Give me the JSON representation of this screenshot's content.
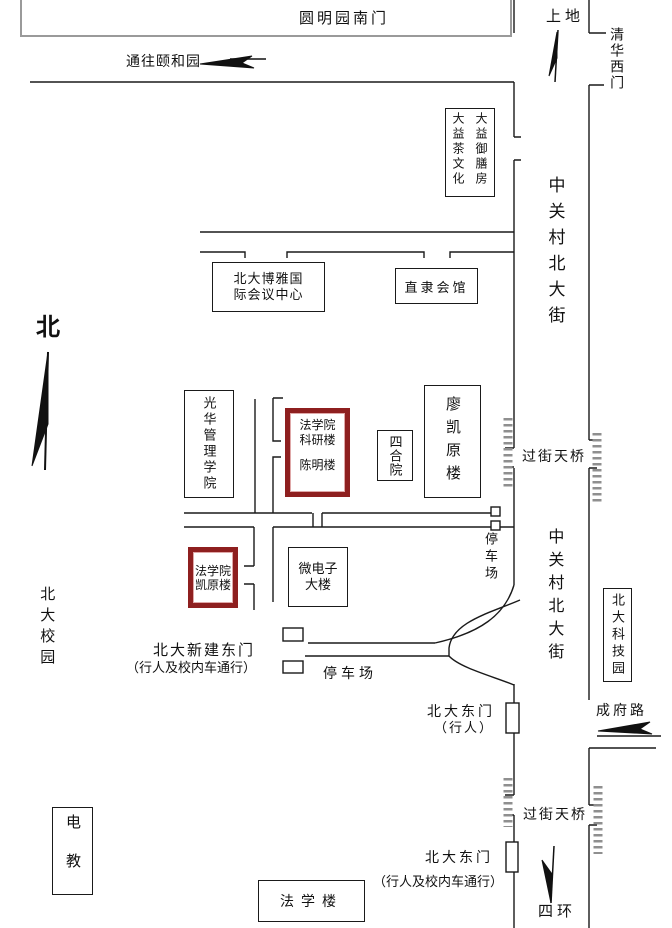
{
  "highlight_color": "#8e1f1f",
  "road_color": "#1a1a1a",
  "footbridge_color": "#8f8f8f",
  "north": {
    "label": "北"
  },
  "top_area": {
    "yuanmingyuan_south_gate": "圆明园南门",
    "shangdi": "上地",
    "tsinghua_west_gate": "清华西门",
    "to_summer_palace": "通往颐和园"
  },
  "streets": {
    "zhongguancun_north_st_upper": "中关村北大街",
    "zhongguancun_north_st_lower": "中关村北大街",
    "chengfu_road": "成府路",
    "fourth_ring": "四环"
  },
  "campus": {
    "pku_campus": "北大校园"
  },
  "buildings": {
    "dayi_right_col": "大益御膳房",
    "dayi_left_col": "大益茶文化",
    "boya_center": "北大博雅国际会议中心",
    "zhili_guildhall": "直隶会馆",
    "guanghua_school": "光华管理学院",
    "law_research_line1": "法学院科研楼",
    "law_research_line2": "陈明楼",
    "siheyuan": "四合院",
    "liao_kaiyuan_bldg": "廖凯原楼",
    "law_kaiyuan_bldg": "法学院凯原楼",
    "microelectronics_bldg": "微电子大楼",
    "pku_science_park": "北大科技园",
    "dianjiao_bldg": "电教",
    "law_teaching_bldg": "法学楼"
  },
  "gates": {
    "new_east_gate": "北大新建东门",
    "new_east_gate_note": "（行人及校内车通行）",
    "east_gate_ped": "北大东门",
    "east_gate_ped_note": "（行人）",
    "east_gate_south": "北大东门",
    "east_gate_south_note": "（行人及校内车通行）"
  },
  "bridges": {
    "footbridge_upper": "过街天桥",
    "footbridge_lower": "过街天桥"
  },
  "parking": {
    "lot_east": "停车场",
    "lot_south": "停车场"
  }
}
